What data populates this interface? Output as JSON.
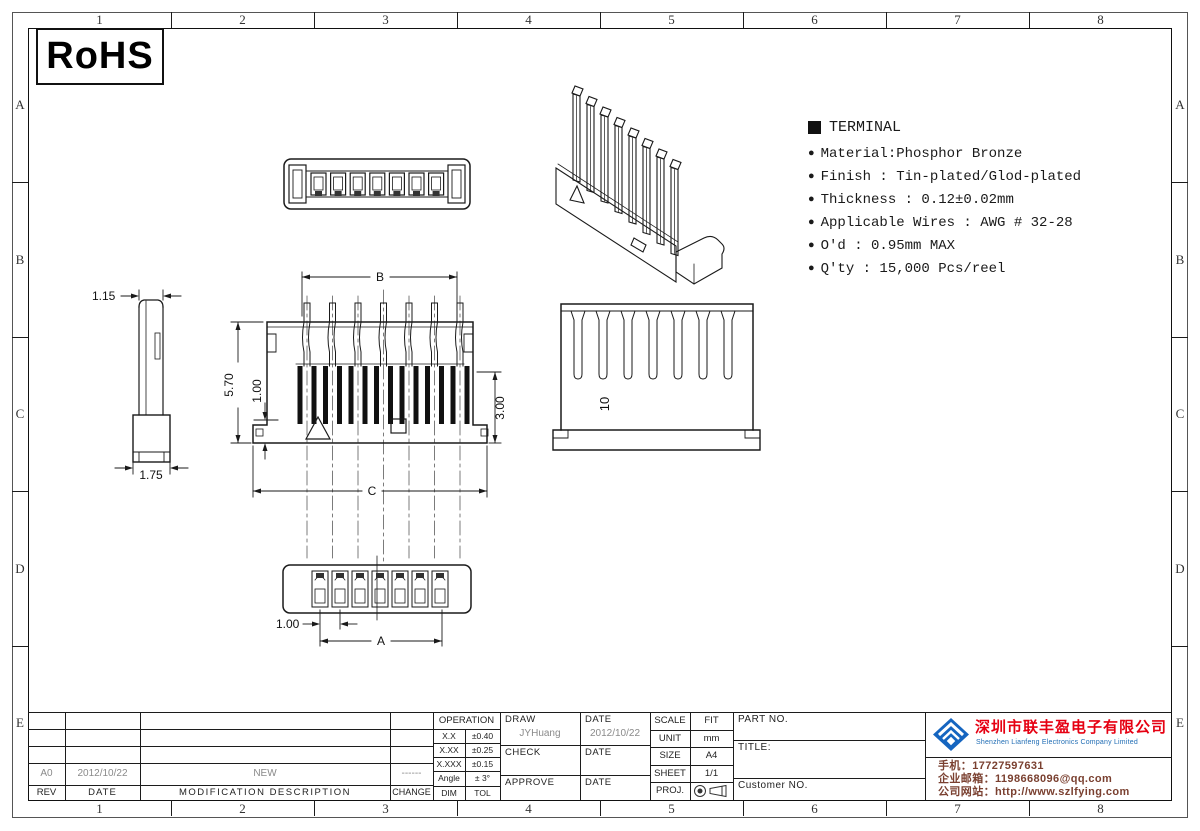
{
  "frame": {
    "cols": [
      "1",
      "2",
      "3",
      "4",
      "5",
      "6",
      "7",
      "8"
    ],
    "rows": [
      "A",
      "B",
      "C",
      "D",
      "E"
    ]
  },
  "rohs": "RoHS",
  "notes": {
    "bullet": "●",
    "title": "TERMINAL",
    "items": [
      "Material:Phosphor Bronze",
      "Finish : Tin-plated/Glod-plated",
      "Thickness : 0.12±0.02mm",
      "Applicable Wires : AWG # 32-28",
      "O'd : 0.95mm MAX",
      "Q'ty : 15,000 Pcs/reel"
    ]
  },
  "dims": {
    "b": "B",
    "c": "C",
    "a": "A",
    "h570": "5.70",
    "v100": "1.00",
    "v300": "3.00",
    "s115": "1.15",
    "s175": "1.75",
    "p100": "1.00",
    "rear10": "10"
  },
  "tolerance": {
    "header": "OPERATION",
    "rows": [
      {
        "dim": "X.X",
        "tol": "±0.40"
      },
      {
        "dim": "X.XX",
        "tol": "±0.25"
      },
      {
        "dim": "X.XXX",
        "tol": "±0.15"
      },
      {
        "dim": "Angle",
        "tol": "± 3°"
      },
      {
        "dim": "DIM",
        "tol": "TOL"
      }
    ]
  },
  "signoff": {
    "draw_label": "DRAW",
    "draw_name": "JYHuang",
    "draw_date_label": "DATE",
    "draw_date": "2012/10/22",
    "check_label": "CHECK",
    "check_date_label": "DATE",
    "approve_label": "APPROVE",
    "approve_date_label": "DATE"
  },
  "sheetinfo": {
    "scale_label": "SCALE",
    "scale": "FIT",
    "unit_label": "UNIT",
    "unit": "mm",
    "size_label": "SIZE",
    "size": "A4",
    "sheet_label": "SHEET",
    "sheet": "1/1",
    "proj_label": "PROJ."
  },
  "product": {
    "part_no_label": "PART NO.",
    "title_label": "TITLE:",
    "customer_label": "Customer NO."
  },
  "revision": {
    "row": {
      "rev": "A0",
      "date": "2012/10/22",
      "desc": "NEW",
      "change": "------"
    },
    "headers": {
      "rev": "REV",
      "date": "DATE",
      "desc": "MODIFICATION DESCRIPTION",
      "change": "CHANGE"
    }
  },
  "company": {
    "name_cn": "深圳市联丰盈电子有限公司",
    "name_en": "Shenzhen Lianfeng Electronics Company Limited",
    "phone": "手机：17727597631",
    "email": "企业邮箱：1198668096@qq.com",
    "website": "公司网站：http://www.szlfying.com",
    "name_color": "#e60012",
    "name_en_color": "#1f6cb4",
    "contact_color": "#7a4030",
    "logo_color": "#1565c0"
  }
}
